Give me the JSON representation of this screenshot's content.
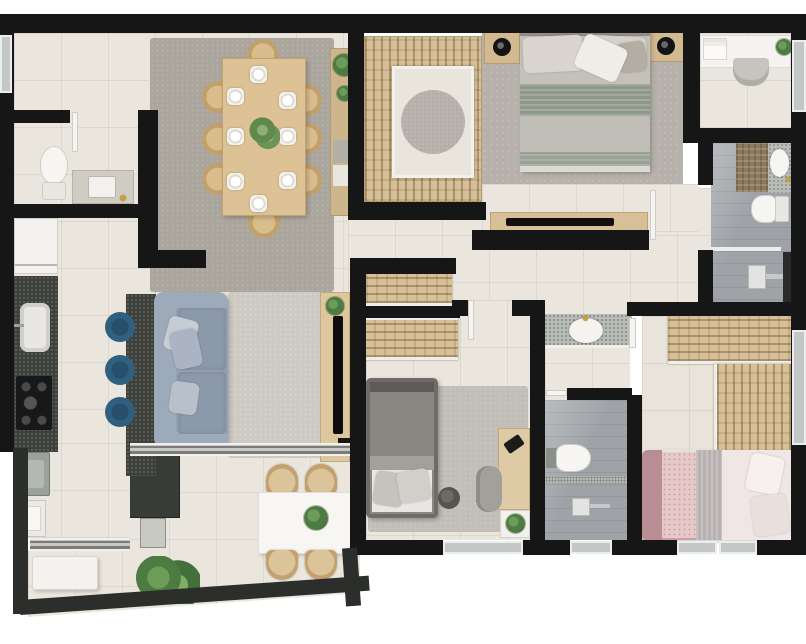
{
  "scene": {
    "type": "residential-apartment-floor-plan-3d-top-view",
    "background_color": "#ffffff",
    "palette": {
      "wall": "#161616",
      "tile_floor": "#eae6dd",
      "wood_furniture": "#d7c097",
      "dining_rug": "#aba69d",
      "living_rug": "#cdcac3",
      "master_carpet": "#b6b2ab",
      "bedroom2_rug": "#c1beb7",
      "sofa_blue_gray": "#93a0b1",
      "counter_dark_granite": "#3d403b",
      "bar_stool_blue": "#30607f",
      "bathroom_floor": "#9fa3a7",
      "terrazzo_counter": "#b9bdb7",
      "fixture_white": "#f4f3f0",
      "plant_green": "#4d7c42",
      "sage_blanket": "#8e9889",
      "bedroom3_mauve": "#c09399",
      "window_glass": "#c3c7c6",
      "balcony_railing": "#2b2e2b",
      "gold_fixture": "#c9a23a"
    },
    "rooms": [
      {
        "id": "entry-hall",
        "furniture": []
      },
      {
        "id": "powder-room",
        "furniture": [
          "toilet",
          "vanity-counter",
          "inset-sink",
          "gold-faucet",
          "door"
        ]
      },
      {
        "id": "dining-room",
        "furniture": [
          "dining-table",
          "dining-chair x8",
          "plate x8",
          "centerpiece-plant",
          "sideboard",
          "potted-plant x2",
          "area-rug"
        ]
      },
      {
        "id": "kitchen-laundry",
        "furniture": [
          "refrigerator",
          "dark-countertop",
          "kitchen-sink",
          "gas-cooktop-4-burner",
          "washing-machine",
          "laundry-tub",
          "island-counter",
          "bar-stool x3"
        ]
      },
      {
        "id": "living-room",
        "furniture": [
          "sofa",
          "throw-pillow x3",
          "area-rug",
          "tv-panel",
          "tv",
          "plant"
        ]
      },
      {
        "id": "balcony",
        "furniture": [
          "grill-counter",
          "mini-fridge",
          "bench",
          "floor-plant",
          "outdoor-table",
          "table-plant",
          "rattan-chair x4",
          "glass-railing",
          "sliding-door x2"
        ]
      },
      {
        "id": "master-suite",
        "furniture": [
          "walk-in-closet-u-wardrobe",
          "round-rug",
          "double-bed",
          "pillows",
          "sage-knit-blanket",
          "nightstand x2",
          "black-lamp x2",
          "tv-console",
          "tv",
          "door"
        ]
      },
      {
        "id": "home-office-nook",
        "furniture": [
          "white-desk",
          "book-stack",
          "desk-plant",
          "chair"
        ]
      },
      {
        "id": "master-bathroom",
        "furniture": [
          "bronze-tile-panel",
          "terrazzo-vanity",
          "oval-basin",
          "gold-faucet",
          "toilet",
          "shower-area",
          "drain",
          "glass-divider"
        ]
      },
      {
        "id": "hallway",
        "furniture": [
          "linen-closet x2"
        ]
      },
      {
        "id": "bedroom-2",
        "furniture": [
          "single-bed",
          "pillow x2",
          "area-rug",
          "pouf",
          "desk",
          "laptop",
          "desk-chair",
          "shelf-plant",
          "window",
          "door"
        ]
      },
      {
        "id": "shared-vanity-alcove",
        "furniture": [
          "terrazzo-counter",
          "oval-basin",
          "gold-faucet"
        ]
      },
      {
        "id": "bathroom-2",
        "furniture": [
          "toilet",
          "shower-area",
          "drain",
          "terrazzo-threshold",
          "window",
          "door"
        ]
      },
      {
        "id": "bedroom-3",
        "furniture": [
          "l-shaped-wardrobe",
          "bed",
          "mauve-headboard",
          "floral-pillows",
          "knit-blanket",
          "duvet",
          "mauve-rug",
          "window x2",
          "door"
        ]
      }
    ]
  }
}
